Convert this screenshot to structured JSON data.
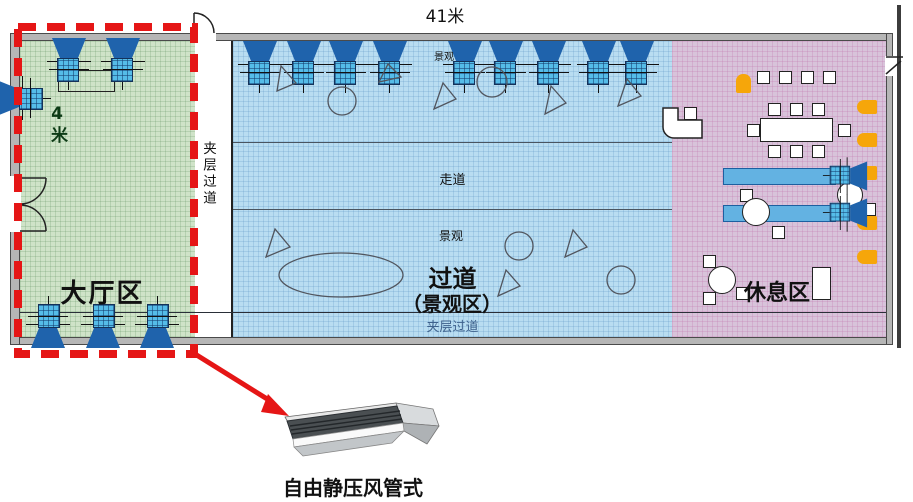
{
  "title": "41米",
  "left_dimension": "4米",
  "zones": {
    "lobby": {
      "name": "大厅区",
      "fill": "#cfe3c8"
    },
    "corridor_left": {
      "name": "夹层过道"
    },
    "walkway": {
      "fill": "#b9ddf1",
      "walkway_label": "走道",
      "landscape_top": "景观",
      "landscape_mid": "景观",
      "main_label": "过道",
      "sub_label": "（景观区）",
      "bottom_corridor": "夹层过道"
    },
    "rest": {
      "name": "休息区",
      "fill": "#d8c3da"
    }
  },
  "callout": {
    "label": "自由静压风管式",
    "color": "#e51616"
  },
  "palette": {
    "fan_dark": "#1f63ac",
    "fan_grid": "#55bce8",
    "wall": "#b6b6b6",
    "orange": "#f6a60a",
    "bar_blue": "#63b2e2",
    "corridor_text": "#3e618c",
    "left_dim_text": "#0d3b16"
  }
}
